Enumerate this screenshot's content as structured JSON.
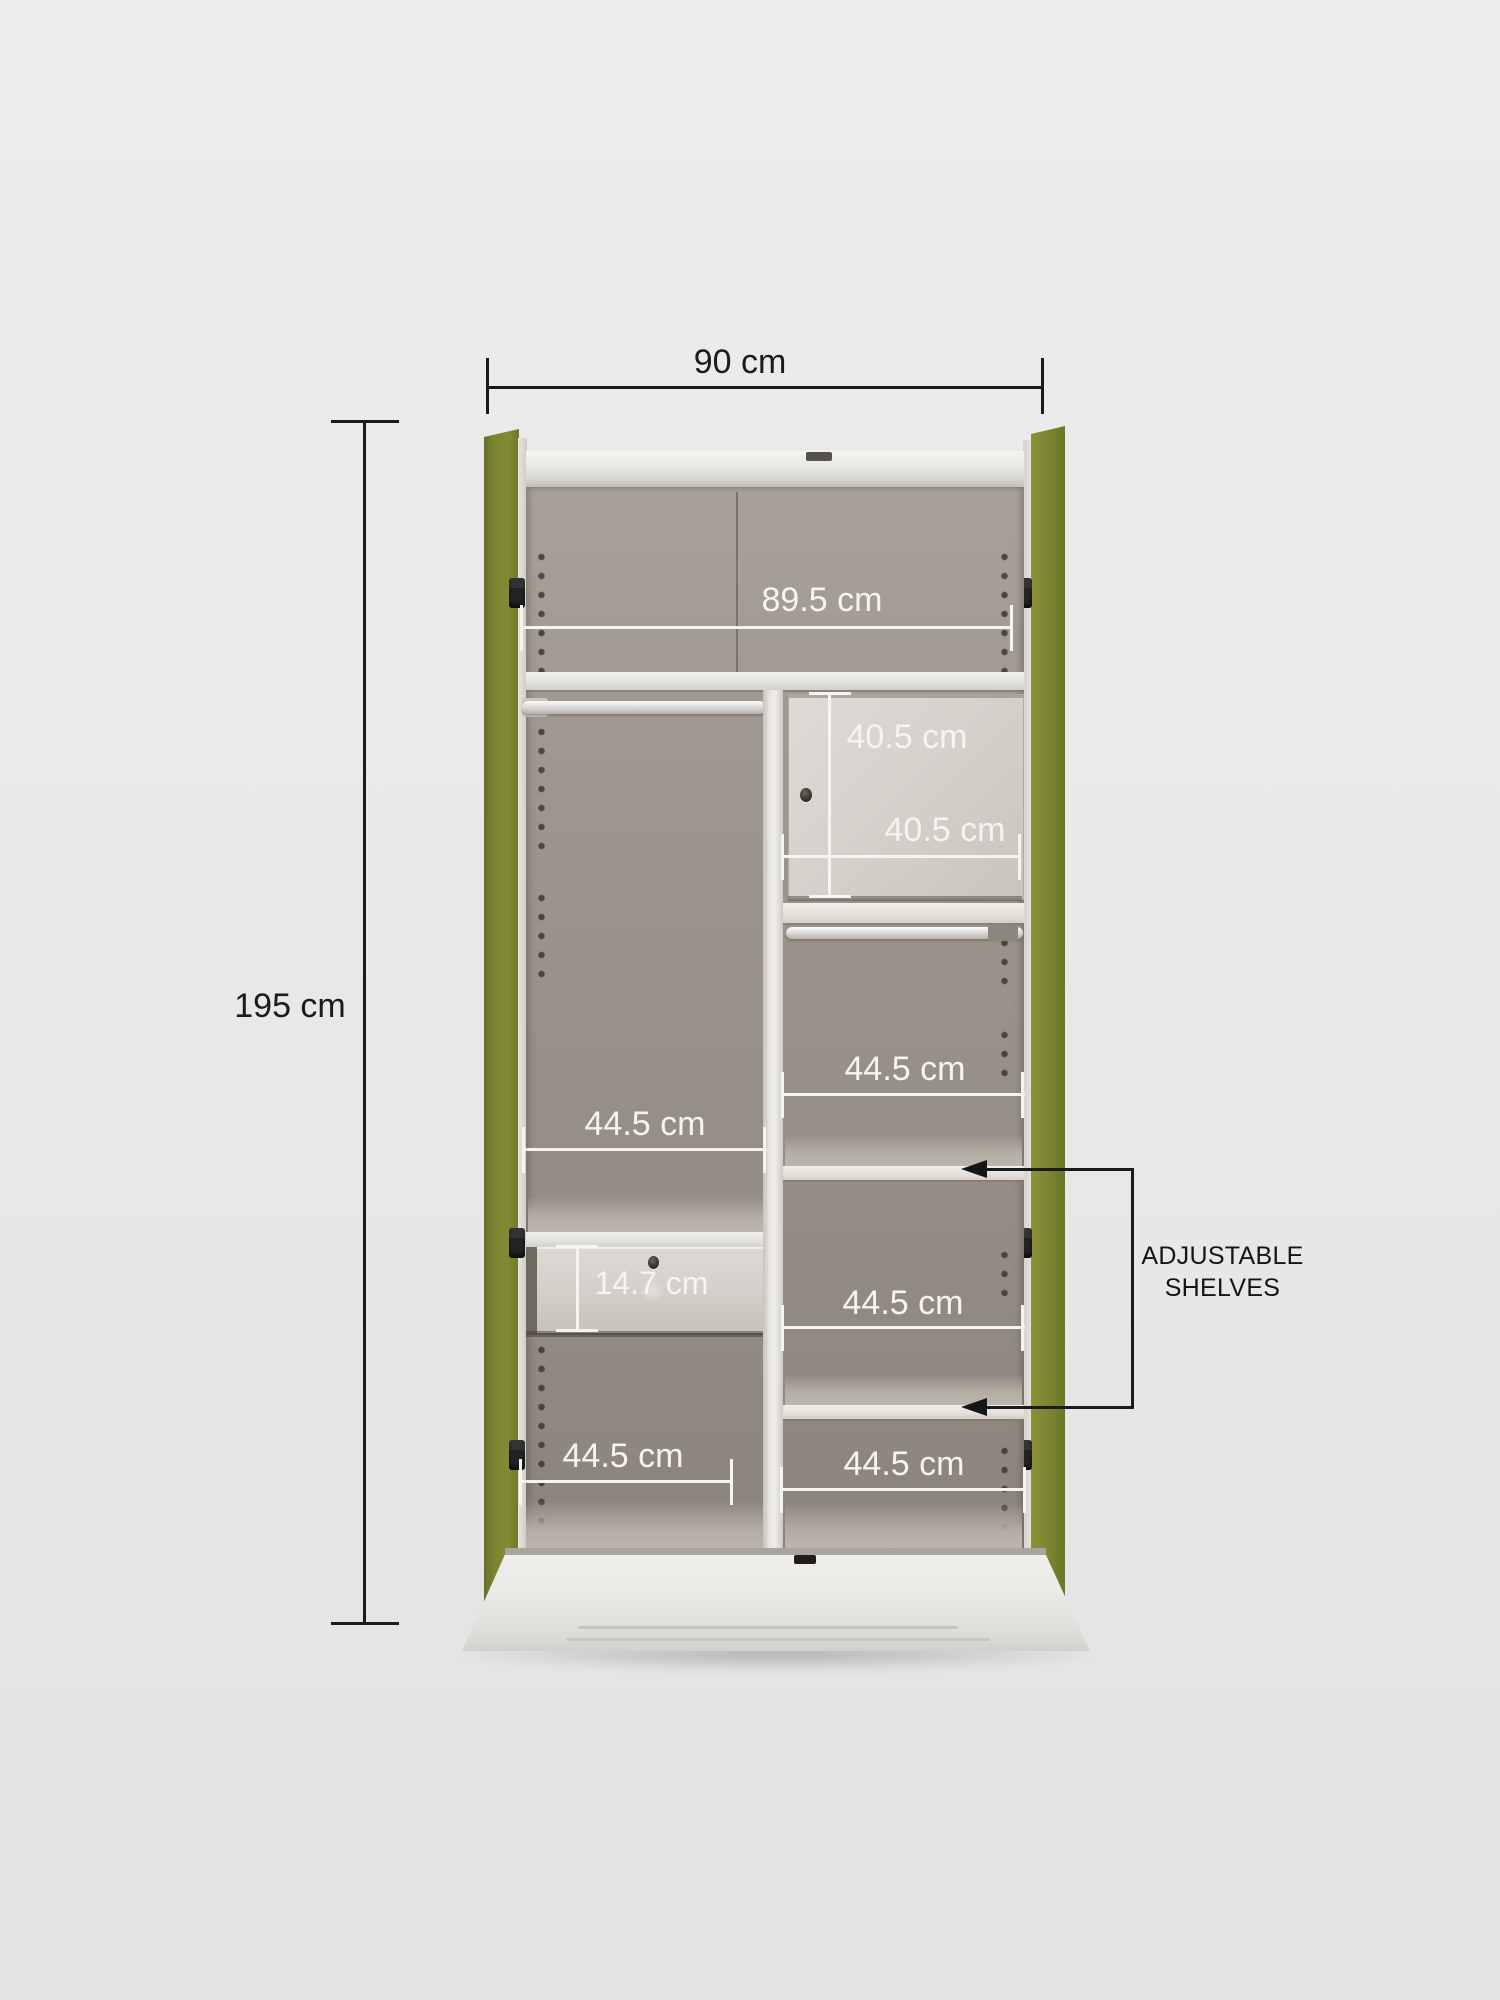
{
  "diagram": {
    "subject": "two-door steel wardrobe interior dimension diagram",
    "colors": {
      "door_green": "#7b8430",
      "background": "#e9e9e9",
      "interior_taupe": "#9d968c",
      "panel_white": "#e9e7e2",
      "annotation_black": "#1b1b1b",
      "annotation_white": "#f5f4ef"
    }
  },
  "dims": {
    "overall_width": "90 cm",
    "overall_height": "195 cm",
    "top_shelf_width": "89.5 cm",
    "locker_height": "40.5 cm",
    "locker_width": "40.5 cm",
    "hanging_section_width": "44.5 cm",
    "right_upper_section_width": "44.5 cm",
    "right_middle_section_width": "44.5 cm",
    "left_bottom_section_width": "44.5 cm",
    "right_bottom_section_width": "44.5 cm",
    "drawer_height": "14.7 cm"
  },
  "callout": {
    "line1": "ADJUSTABLE",
    "line2": "SHELVES"
  }
}
